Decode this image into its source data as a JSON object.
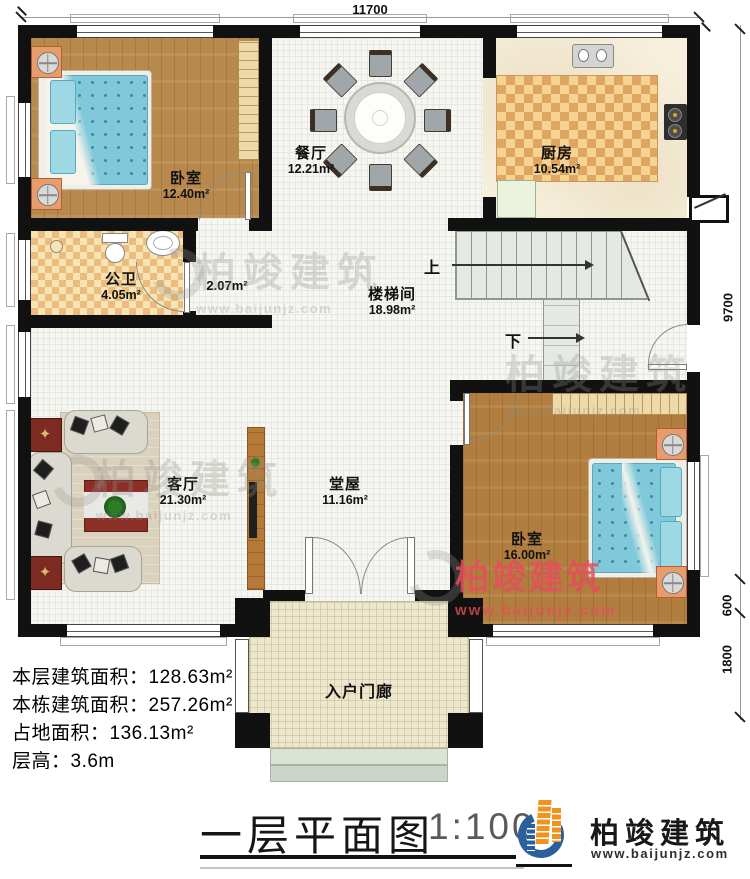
{
  "plan": {
    "dim_top": "11700",
    "dim_right": [
      "9700",
      "600",
      "1800"
    ],
    "rooms": {
      "bedroom1": {
        "name": "卧室",
        "area": "12.40m²"
      },
      "dining": {
        "name": "餐厅",
        "area": "12.21m²"
      },
      "kitchen": {
        "name": "厨房",
        "area": "10.54m²"
      },
      "bathroom": {
        "name": "公卫",
        "area": "4.05m²"
      },
      "vestibule": {
        "area": "2.07m²"
      },
      "stairwell": {
        "name": "楼梯间",
        "area": "18.98m²"
      },
      "living": {
        "name": "客厅",
        "area": "21.30m²"
      },
      "hall": {
        "name": "堂屋",
        "area": "11.16m²"
      },
      "bedroom2": {
        "name": "卧室",
        "area": "16.00m²"
      },
      "porch": {
        "name": "入户门廊"
      }
    },
    "stairs": {
      "up": "上",
      "down": "下"
    }
  },
  "info": {
    "lines": [
      "本层建筑面积：128.63m²",
      "本栋建筑面积：257.26m²",
      "占地面积：136.13m²",
      "层高：3.6m"
    ]
  },
  "footer": {
    "title": "一层平面图",
    "scale": "1:100"
  },
  "brand": {
    "name": "柏竣建筑",
    "url": "www.baijunjz.com"
  },
  "colors": {
    "wall": "#111111",
    "watermark_red": "#e44d5c",
    "brand_blue": "#2b5f9e",
    "brand_orange": "#f0931f"
  }
}
